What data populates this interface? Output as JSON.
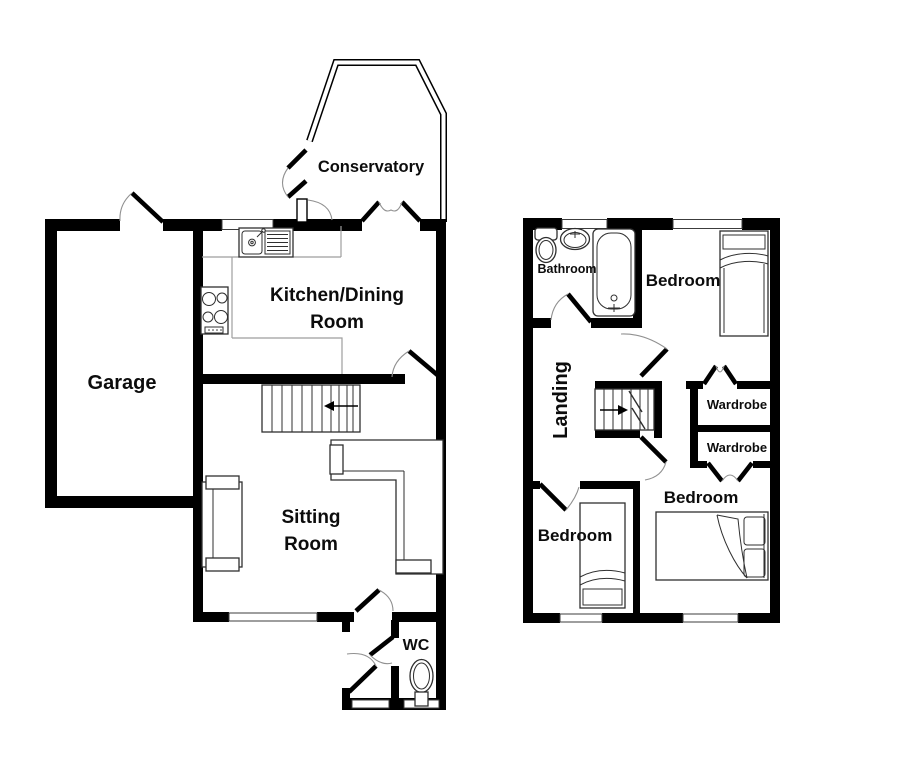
{
  "title": "Two storey house floorplan",
  "colors": {
    "wall": "#000000",
    "background": "#ffffff",
    "counter_line": "#9e9e9e",
    "furniture_line": "#2f2f2f",
    "door_arc": "#909090"
  },
  "ground_floor": {
    "rooms": {
      "conservatory": {
        "label": "Conservatory"
      },
      "kitchen": {
        "label_line1": "Kitchen/Dining",
        "label_line2": "Room"
      },
      "garage": {
        "label": "Garage"
      },
      "sitting": {
        "label_line1": "Sitting",
        "label_line2": "Room"
      },
      "wc": {
        "label": "WC"
      }
    },
    "fixtures": [
      "sink-drainer-unit",
      "hob",
      "staircase",
      "corner-sofa",
      "sofa",
      "toilet"
    ],
    "stairs_arrow_direction": "left"
  },
  "first_floor": {
    "rooms": {
      "bathroom": {
        "label": "Bathroom"
      },
      "bedroom_top": {
        "label": "Bedroom"
      },
      "landing": {
        "label": "Landing"
      },
      "wardrobe_upper": {
        "label": "Wardrobe"
      },
      "wardrobe_lower": {
        "label": "Wardrobe"
      },
      "bedroom_left": {
        "label": "Bedroom"
      },
      "bedroom_right": {
        "label": "Bedroom"
      }
    },
    "fixtures": [
      "toilet",
      "basin",
      "bathtub",
      "single-bed",
      "single-bed",
      "double-bed",
      "staircase"
    ],
    "stairs_arrow_direction": "right"
  }
}
